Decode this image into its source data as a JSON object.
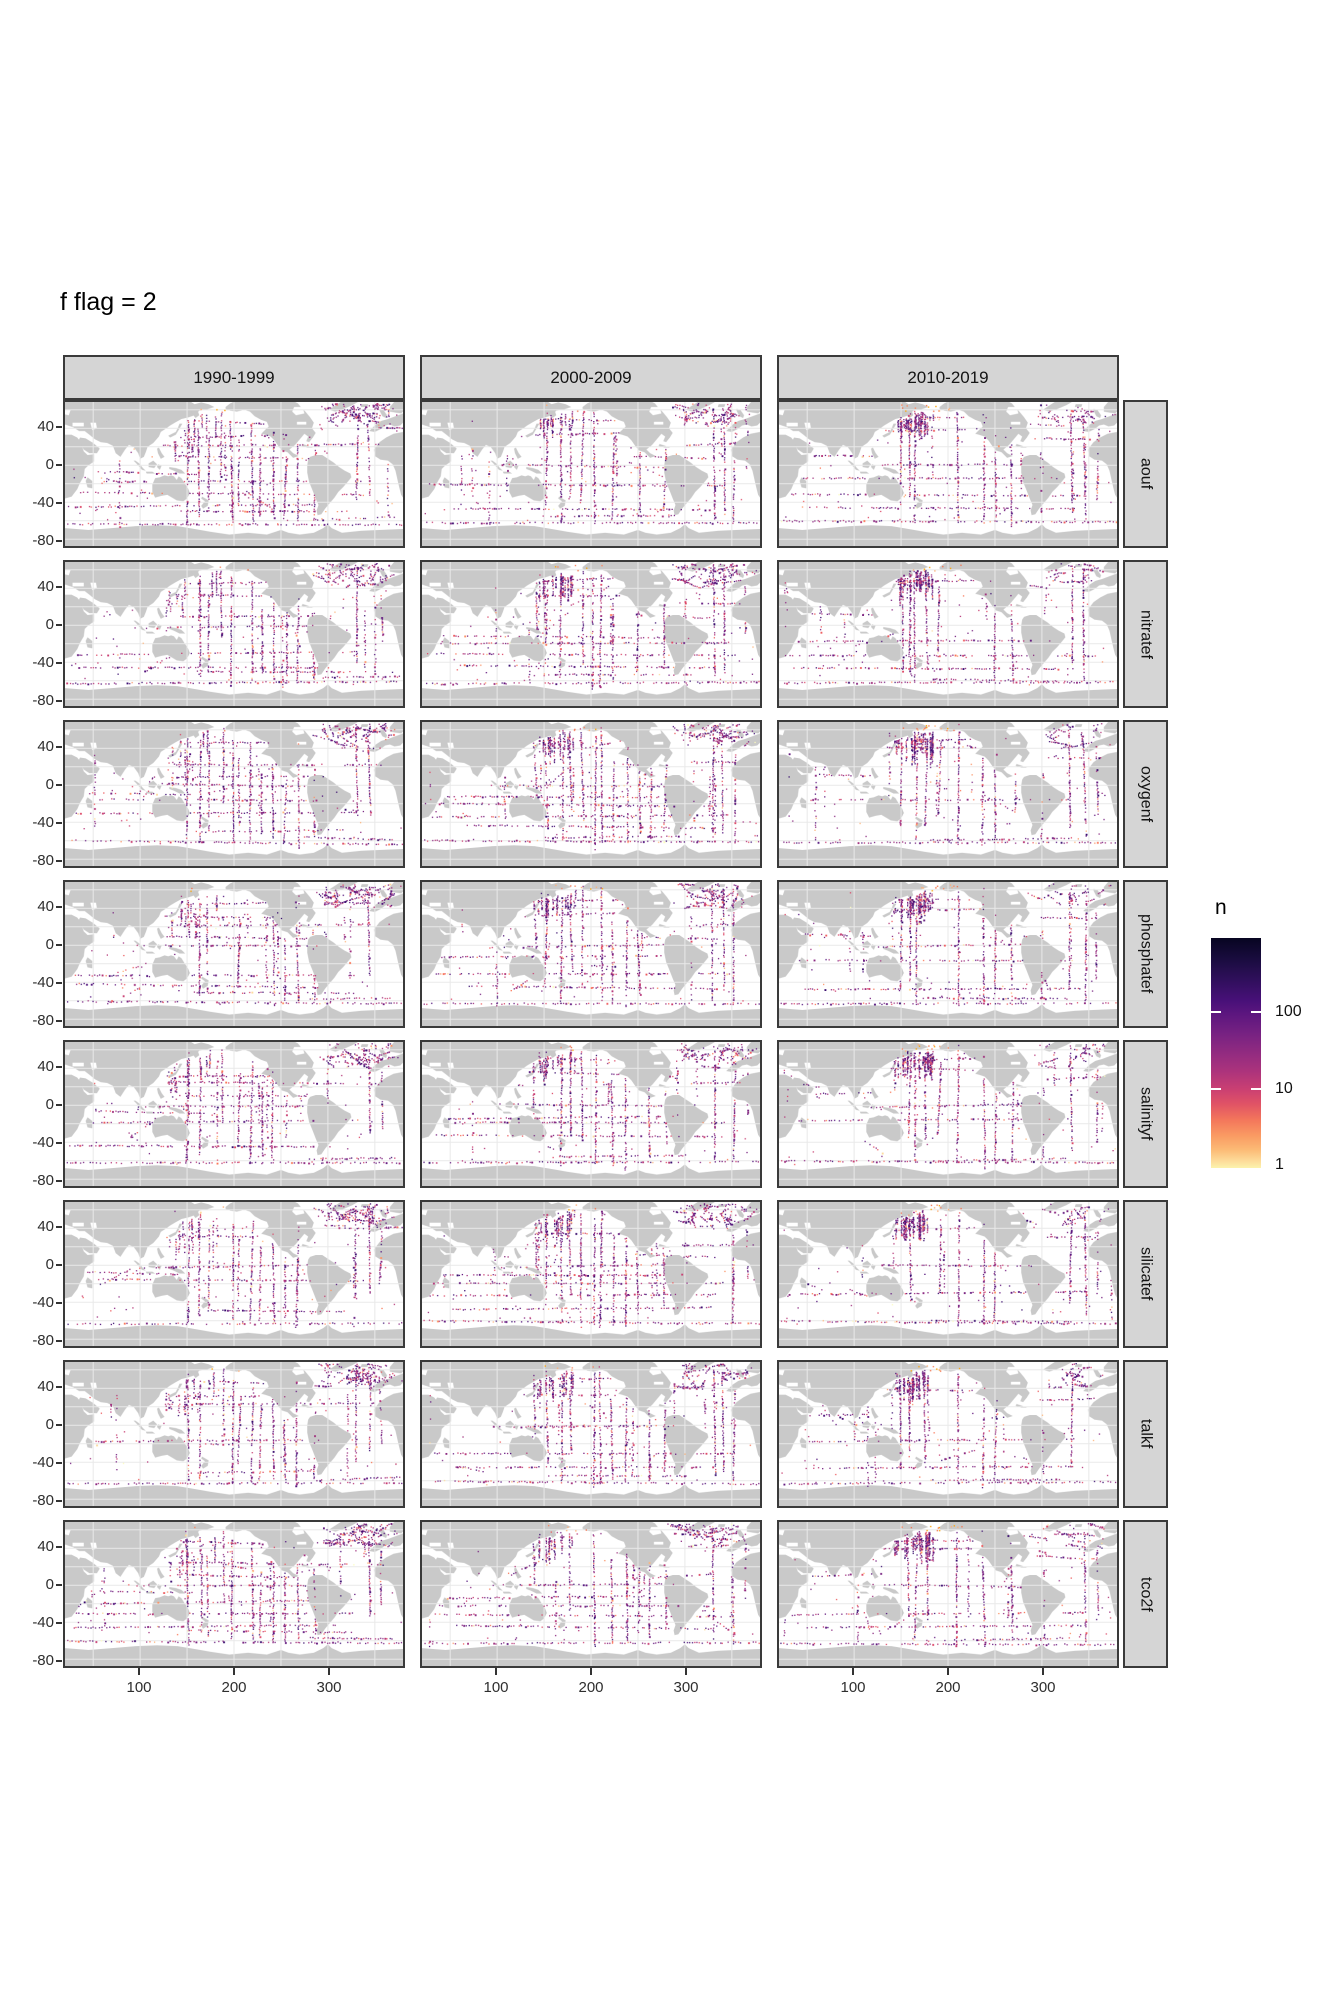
{
  "title": "f flag = 2",
  "facets": {
    "columns": [
      "1990-1999",
      "2000-2009",
      "2010-2019"
    ],
    "rows": [
      "aouf",
      "nitratef",
      "oxygenf",
      "phosphatef",
      "salinityf",
      "silicatef",
      "talkf",
      "tco2f"
    ]
  },
  "axes": {
    "x_ticks": [
      "100",
      "200",
      "300"
    ],
    "y_ticks": [
      "40",
      "0",
      "-40",
      "-80"
    ]
  },
  "legend": {
    "title": "n",
    "tick_labels": [
      "100",
      "10",
      "1"
    ]
  },
  "colors": {
    "land": "#c9c9c9",
    "ocean": "#ffffff",
    "gridline": "#e9e9e9",
    "strip_fill": "#d5d5d5",
    "panel_border": "#3a3a3a",
    "colormap_dark_to_light": [
      "#070521",
      "#1d1147",
      "#451077",
      "#5c167f",
      "#782282",
      "#952c80",
      "#b0357b",
      "#cb4072",
      "#e05266",
      "#f3765b",
      "#fa9b63",
      "#fcba75",
      "#fddc9a",
      "#fcf3ad"
    ]
  },
  "chart_data": {
    "type": "scatter",
    "subtype": "faceted world maps of observation counts along cruise tracks",
    "title": "f flag = 2",
    "facet_grid": {
      "rows": [
        "aouf",
        "nitratef",
        "oxygenf",
        "phosphatef",
        "salinityf",
        "silicatef",
        "talkf",
        "tco2f"
      ],
      "columns": [
        "1990-1999",
        "2000-2009",
        "2010-2019"
      ]
    },
    "x": {
      "label": "",
      "ticks": [
        100,
        200,
        300
      ],
      "range": [
        20,
        380
      ]
    },
    "y": {
      "label": "",
      "ticks": [
        40,
        0,
        -40,
        -80
      ],
      "range": [
        -88,
        68
      ]
    },
    "color_scale": {
      "name": "n",
      "type": "log10",
      "breaks": [
        100,
        10,
        1
      ],
      "domain_approx": [
        1,
        1000
      ],
      "palette": "magma reversed (pale yellow = 1, magenta ~ 10, dark purple/black = 100+)"
    },
    "grid": true,
    "legend_position": "right",
    "note": "24 identical gray-land world basemaps (Pacific-centered, lon 20-380); colored dots trace ship tracks, dot color = count n on a log scale."
  }
}
